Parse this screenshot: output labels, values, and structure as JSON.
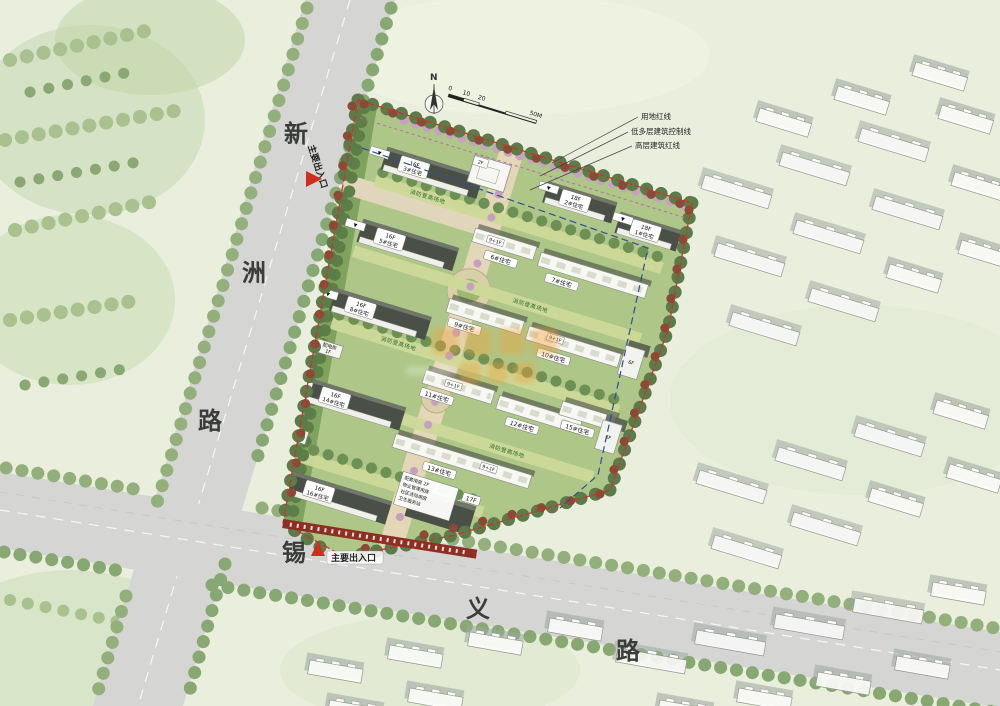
{
  "roads": {
    "west": {
      "chars": [
        "新",
        "洲",
        "路"
      ]
    },
    "south": {
      "chars": [
        "锡",
        "义",
        "路"
      ]
    }
  },
  "entrances": {
    "west": "主要出入口",
    "south": "主要出入口"
  },
  "compass": {
    "north": "N"
  },
  "scale_bar": {
    "ticks": [
      "0",
      "10",
      "20"
    ],
    "end": "50M"
  },
  "legend": {
    "items": [
      "用地红线",
      "低多层建筑控制线",
      "高层建筑红线"
    ]
  },
  "site": {
    "slabs": [
      {
        "floors": "16F",
        "name": "3#住宅"
      },
      {
        "floors": "16F",
        "name": "5#住宅"
      },
      {
        "floors": "16F",
        "name": "8#住宅"
      },
      {
        "floors": "16F",
        "name": "14#住宅"
      },
      {
        "floors": "16F",
        "name": "16#住宅"
      },
      {
        "floors": "18F",
        "name": "2#住宅"
      },
      {
        "floors": "18F",
        "name": "1#住宅"
      }
    ],
    "rows": [
      {
        "name": "6#住宅"
      },
      {
        "name": "7#住宅"
      },
      {
        "name": "9#住宅"
      },
      {
        "name": "10#住宅"
      },
      {
        "name": "11#住宅"
      },
      {
        "name": "12#住宅"
      },
      {
        "name": "15#住宅"
      },
      {
        "name": "13#住宅"
      }
    ],
    "utility": [
      {
        "name": "配电房",
        "floors": "1F"
      },
      {
        "name": "配电房",
        "floors": "2F"
      }
    ],
    "clubhouse": {
      "floors": "2F"
    },
    "annex": {
      "floors": "17F",
      "lines": [
        "配套用房 2F",
        "物业管理用房",
        "社区活动用房",
        "卫生服务站"
      ]
    },
    "fire_lane_label": "消防登高场地",
    "unit_floor_labels": [
      "9+1F",
      "6F"
    ],
    "elevation_marker": "▼"
  },
  "colors": {
    "background": "#e9eedd",
    "road": "#d5d6d4",
    "site_green": "#aec687",
    "buffer_green": "#7fa35e",
    "fire_lane": "#cdd998",
    "slab_dark": "#4a5047",
    "boundary_red": "#c23a28",
    "highrise_line_blue": "#2e4f96",
    "lowrise_line_pink": "#b66ab0",
    "banner_red": "#8e2f23",
    "entrance_red": "#cf2e1e",
    "watermark_orange": "#f0a13c"
  }
}
